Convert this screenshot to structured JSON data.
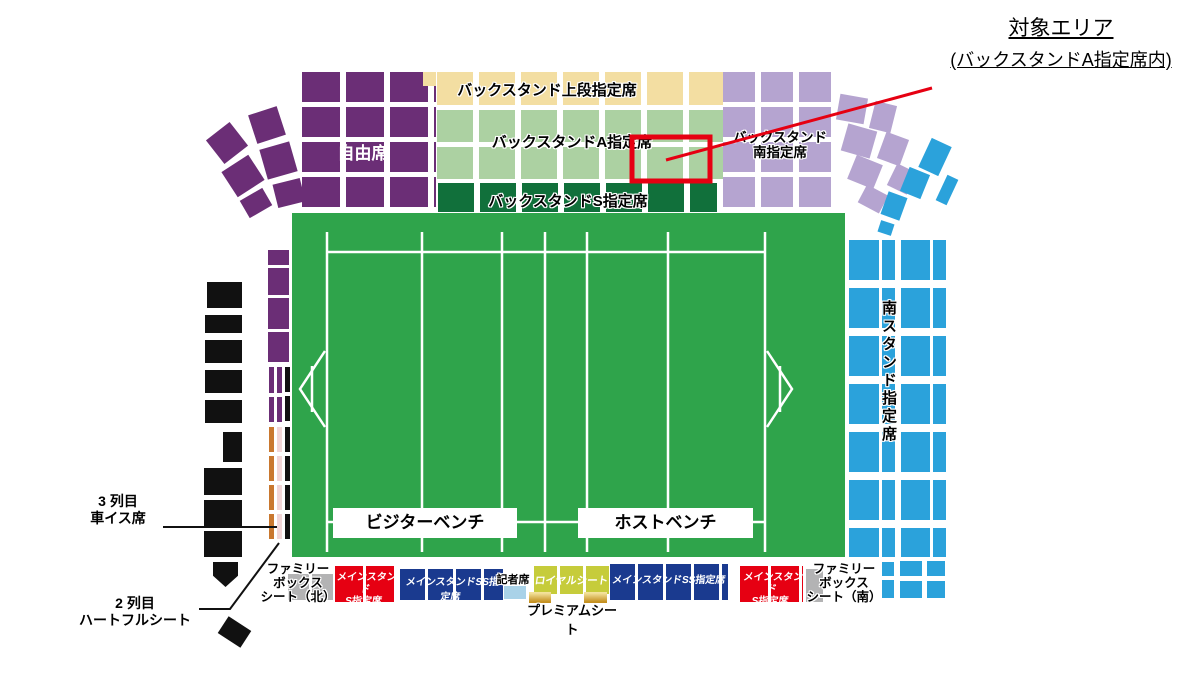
{
  "annotation": {
    "line1": "対象エリア",
    "line2": "(バックスタンドA指定席内)"
  },
  "stands": {
    "free": "自由席",
    "back_upper": "バックスタンド上段指定席",
    "back_a": "バックスタンドA指定席",
    "back_s": "バックスタンドS指定席",
    "back_south": [
      "バックスタンド",
      "南指定席"
    ],
    "south": "南スタンド指定席"
  },
  "field": {
    "visitor_bench": "ビジターベンチ",
    "host_bench": "ホストベンチ"
  },
  "left": {
    "wheelchair": [
      "3 列目",
      "車イス席"
    ],
    "heartful": [
      "2 列目",
      "ハートフルシート"
    ]
  },
  "bottom": {
    "family_north": [
      "ファミリー",
      "ボックス",
      "シート（北）"
    ],
    "main_s": [
      "メインスタンド",
      "S指定席"
    ],
    "main_ss": "メインスタンドSS指定席",
    "press": "記者席",
    "royal": "ロイヤルシート",
    "premium": "プレミアムシート",
    "family_south": [
      "ファミリー",
      "ボックス",
      "シート（南）"
    ]
  },
  "colors": {
    "purple": "#6B2E76",
    "lpurple": "#B5A4D0",
    "tan": "#F3DEA2",
    "lgreen": "#ACD1A2",
    "dgreen": "#11703B",
    "field": "#2FA44B",
    "blue": "#2BA2DB",
    "navy": "#1A3A8F",
    "red": "#E60012",
    "royal": "#C6CC3B",
    "gray": "#B3B3B4",
    "pressblue": "#A9D2E8",
    "orange": "#C9782F",
    "pink": "#F2D6D7",
    "goldl": "#F3E29B",
    "goldd": "#C49020",
    "ink": "#111111",
    "highlight": "#E60012"
  }
}
